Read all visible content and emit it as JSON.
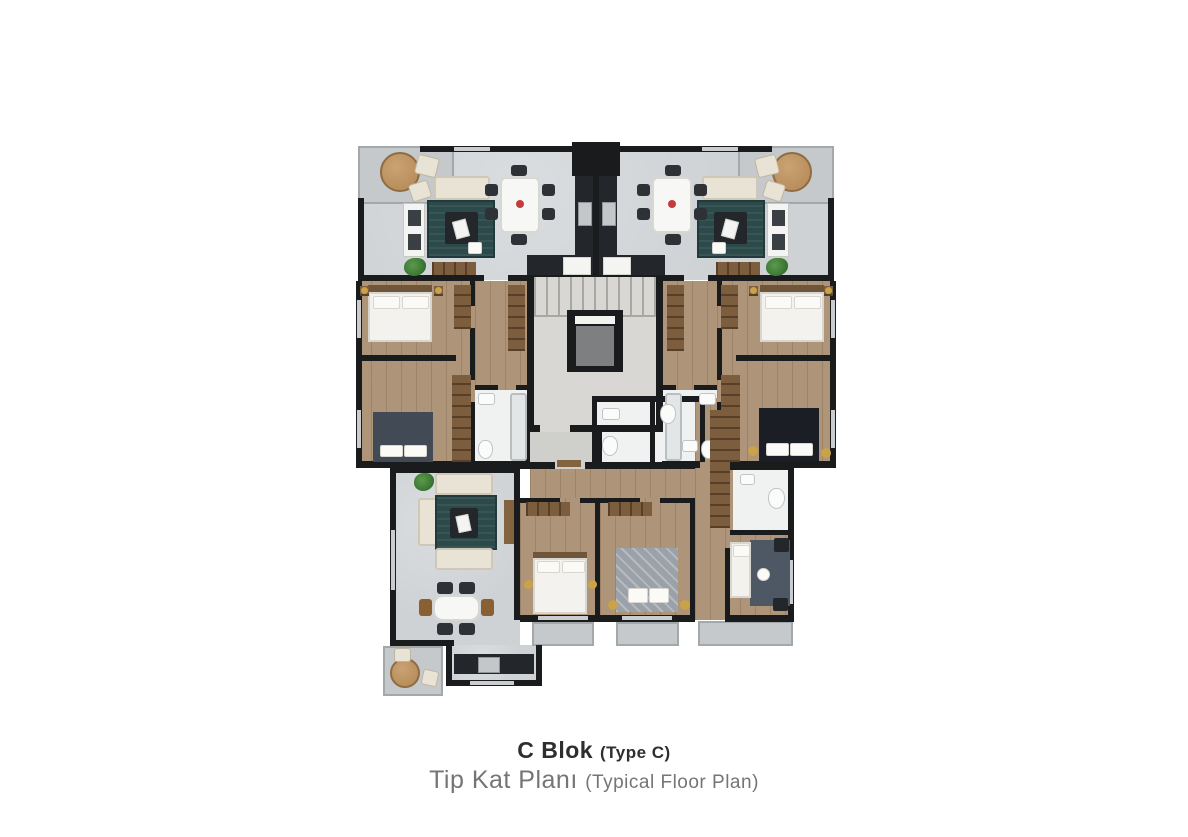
{
  "caption": {
    "block_title": "C Blok",
    "block_title_note": "(Type C)",
    "plan_title": "Tip Kat Planı",
    "plan_title_note": "(Typical Floor Plan)"
  },
  "palette": {
    "wall": "#1a1b1d",
    "living": "#ced2d4",
    "wood": "#ae9478",
    "bath": "#f0f2f1",
    "balcony": "#c5c9cb",
    "stair": "#d8d7d3",
    "elevator": "#7d7f81",
    "rug": "#2d4a4b",
    "sofa": "#e9e3d5",
    "wardrobe": "#7c5d3e",
    "door": "#84643f",
    "counter": "#23272b",
    "table_white": "#f7f7f5",
    "chair_dark": "#2e3237",
    "chair_brown": "#8a5f33",
    "tan": "#b98f5d",
    "plant": "#3f7c36",
    "bed_white": "#f3f2ee",
    "headboard": "#6f5539",
    "bed_slate": "#414a55",
    "bed_black": "#1b1e24",
    "bed_gray": "#9aa1a8",
    "study_rug": "#4e5864",
    "flower": "#c43b3b",
    "gold": "#c9a24a"
  }
}
